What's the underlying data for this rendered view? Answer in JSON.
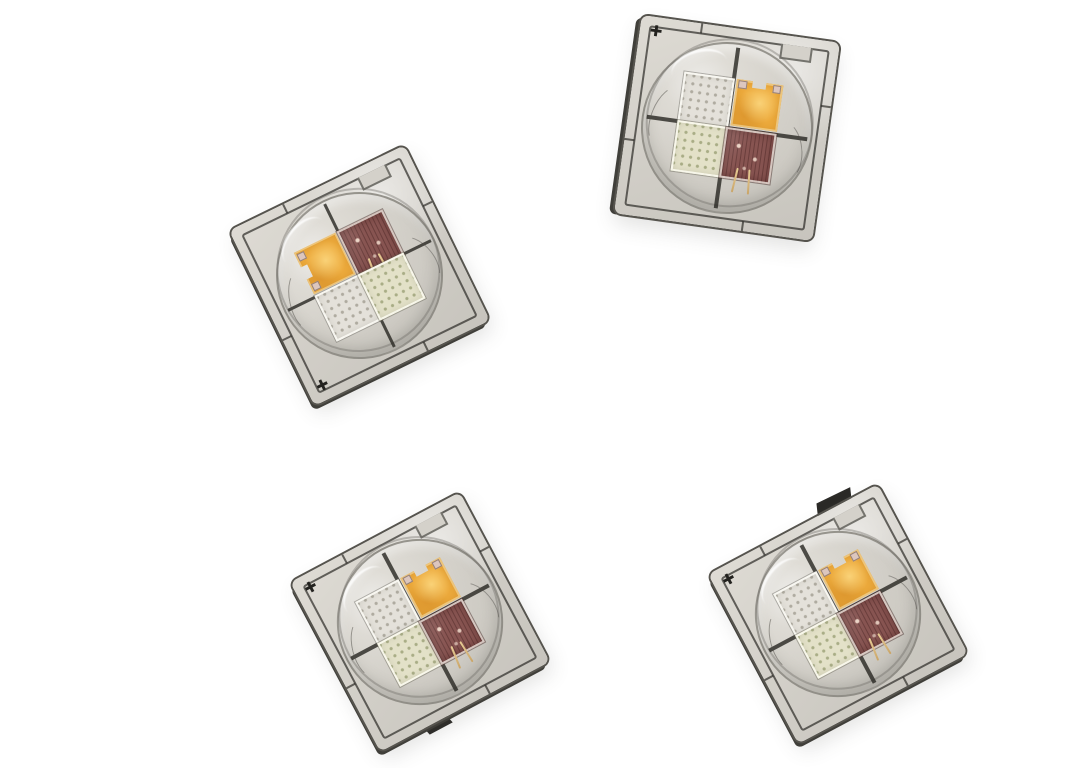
{
  "scene": {
    "description": "Product photograph of four RGBW quad-die high-power SMD LED emitters scattered on a plain white background. Each square ceramic package has a clear silicone dome lens covering a 2x2 die array: one amber phosphor die, one dark red die with gold bond wires, and two pale unlit white dies with micro-dot contact grids. Each package has dark metal trace outlines and a small black cross fiducial mark near one corner.",
    "background_color": "#FFFFFF",
    "object_count": 4
  },
  "fiducial_glyph": "✚",
  "palette": {
    "background": "#FFFFFF",
    "substrate_light": "#DEDBD4",
    "substrate_dark": "#C7C4BD",
    "package_edge": "#56544E",
    "trace_line": "#2F2E2A",
    "dome_tint_light": "#D6D3CC",
    "die_gap": "#2B2925",
    "amber_base": "#EDAB3D",
    "red_base": "#875451",
    "white_cool_base": "#E4E1DA",
    "white_cool_dot": "#AFABA0",
    "white_warm_base": "#E3E1C8",
    "white_warm_dot": "#A9AD86",
    "wire_gold": "#C9A466",
    "pad_silver": "#DCC6BE",
    "fiducial": "#23221F"
  },
  "leds": [
    {
      "id": "led-chip-1",
      "position_label": "top-right",
      "left": 627,
      "top": 28,
      "size": 200,
      "rotation_deg": 8,
      "fiducial_corner": "tl",
      "bevel": "left",
      "tab": null,
      "amber_notch": "top",
      "dies": {
        "tl": "white_cool",
        "tr": "amber",
        "bl": "white_warm",
        "br": "red"
      }
    },
    {
      "id": "led-chip-2",
      "position_label": "middle-left",
      "left": 262,
      "top": 178,
      "size": 195,
      "rotation_deg": -26,
      "fiducial_corner": "bl",
      "bevel": "left-bottom",
      "tab": null,
      "amber_notch": "left",
      "dies": {
        "tl": "amber",
        "tr": "red",
        "bl": "white_cool",
        "br": "white_warm"
      }
    },
    {
      "id": "led-chip-3",
      "position_label": "bottom-left",
      "left": 324,
      "top": 526,
      "size": 192,
      "rotation_deg": -28,
      "fiducial_corner": "tl",
      "bevel": "left-bottom",
      "tab": "bottom",
      "amber_notch": "top",
      "dies": {
        "tl": "white_cool",
        "tr": "amber",
        "bl": "white_warm",
        "br": "red"
      }
    },
    {
      "id": "led-chip-4",
      "position_label": "bottom-right",
      "left": 742,
      "top": 518,
      "size": 192,
      "rotation_deg": -28,
      "fiducial_corner": "tl",
      "bevel": "left-bottom",
      "tab": "top",
      "amber_notch": "top",
      "dies": {
        "tl": "white_cool",
        "tr": "amber",
        "bl": "white_warm",
        "br": "red"
      }
    }
  ]
}
